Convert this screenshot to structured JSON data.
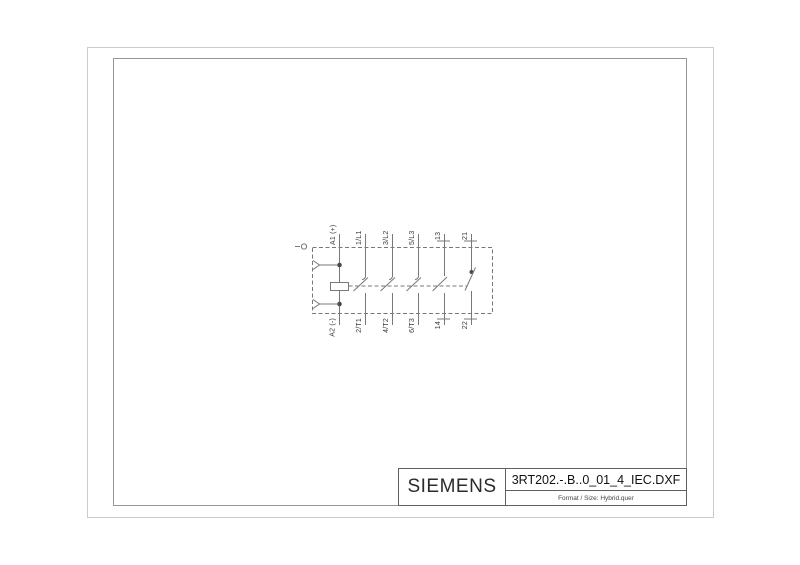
{
  "title_block": {
    "brand": "SIEMENS",
    "filename": "3RT202.-.B..0_01_4_IEC.DXF",
    "format_line": "Format / Size: Hybrid.quer"
  },
  "schematic": {
    "description": "IEC circuit symbol of 3RT202 contactor, rotated 90 degrees",
    "top_terminals": [
      "A1 (+)",
      "1/L1",
      "3/L2",
      "5/L3",
      "13",
      "21"
    ],
    "bottom_terminals": [
      "A2 (-)",
      "2/T1",
      "4/T2",
      "6/T3",
      "14",
      "22"
    ],
    "colors": {
      "sheet_background": "#ffffff",
      "outer_frame": "#cccccc",
      "inner_frame": "#979797",
      "title_block_border": "#5f5f5f",
      "schematic_line": "#787878",
      "label_text": "#3a3a3a"
    }
  }
}
